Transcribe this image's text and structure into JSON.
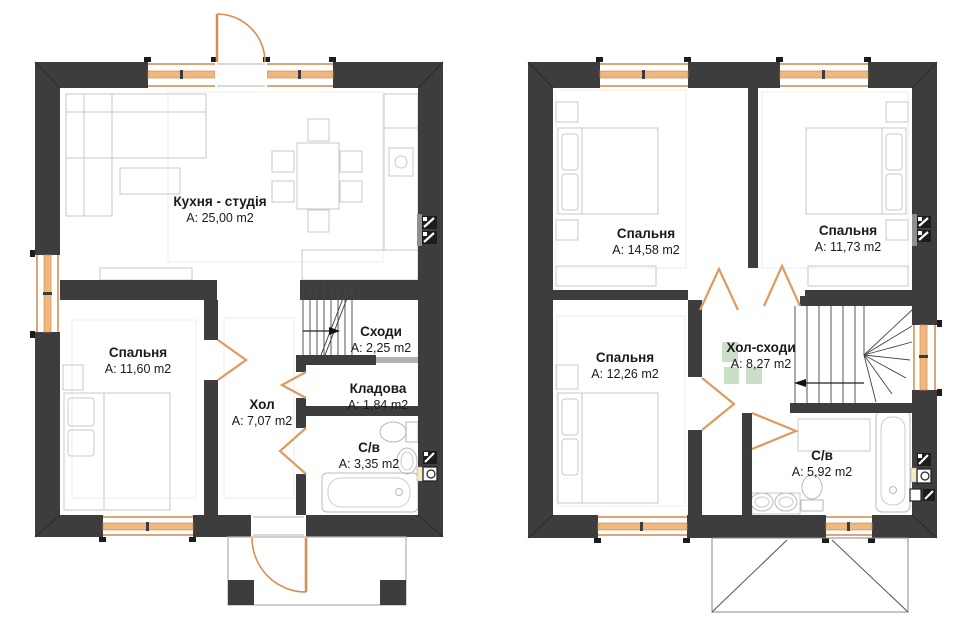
{
  "colors": {
    "wall": "#3d3d3d",
    "joinery_orange": "#d98c4f",
    "window_band": "#f0b77f",
    "furniture_gray": "#c9c9c9",
    "highlight_green": "#c9dfc7"
  },
  "floor1": {
    "rooms": [
      {
        "name": "Кухня - студія",
        "area": "A: 25,00 m2"
      },
      {
        "name": "Спальня",
        "area": "A: 11,60 m2"
      },
      {
        "name": "Сходи",
        "area": "A: 2,25 m2"
      },
      {
        "name": "Хол",
        "area": "A: 7,07 m2"
      },
      {
        "name": "Кладова",
        "area": "A: 1,84 m2"
      },
      {
        "name": "С/в",
        "area": "A: 3,35 m2"
      }
    ]
  },
  "floor2": {
    "rooms": [
      {
        "name": "Спальня",
        "area": "A: 14,58 m2"
      },
      {
        "name": "Спальня",
        "area": "A: 11,73 m2"
      },
      {
        "name": "Спальня",
        "area": "A: 12,26 m2"
      },
      {
        "name": "Хол-сходи",
        "area": "A: 8,27 m2"
      },
      {
        "name": "С/в",
        "area": "A: 5,92 m2"
      }
    ]
  }
}
